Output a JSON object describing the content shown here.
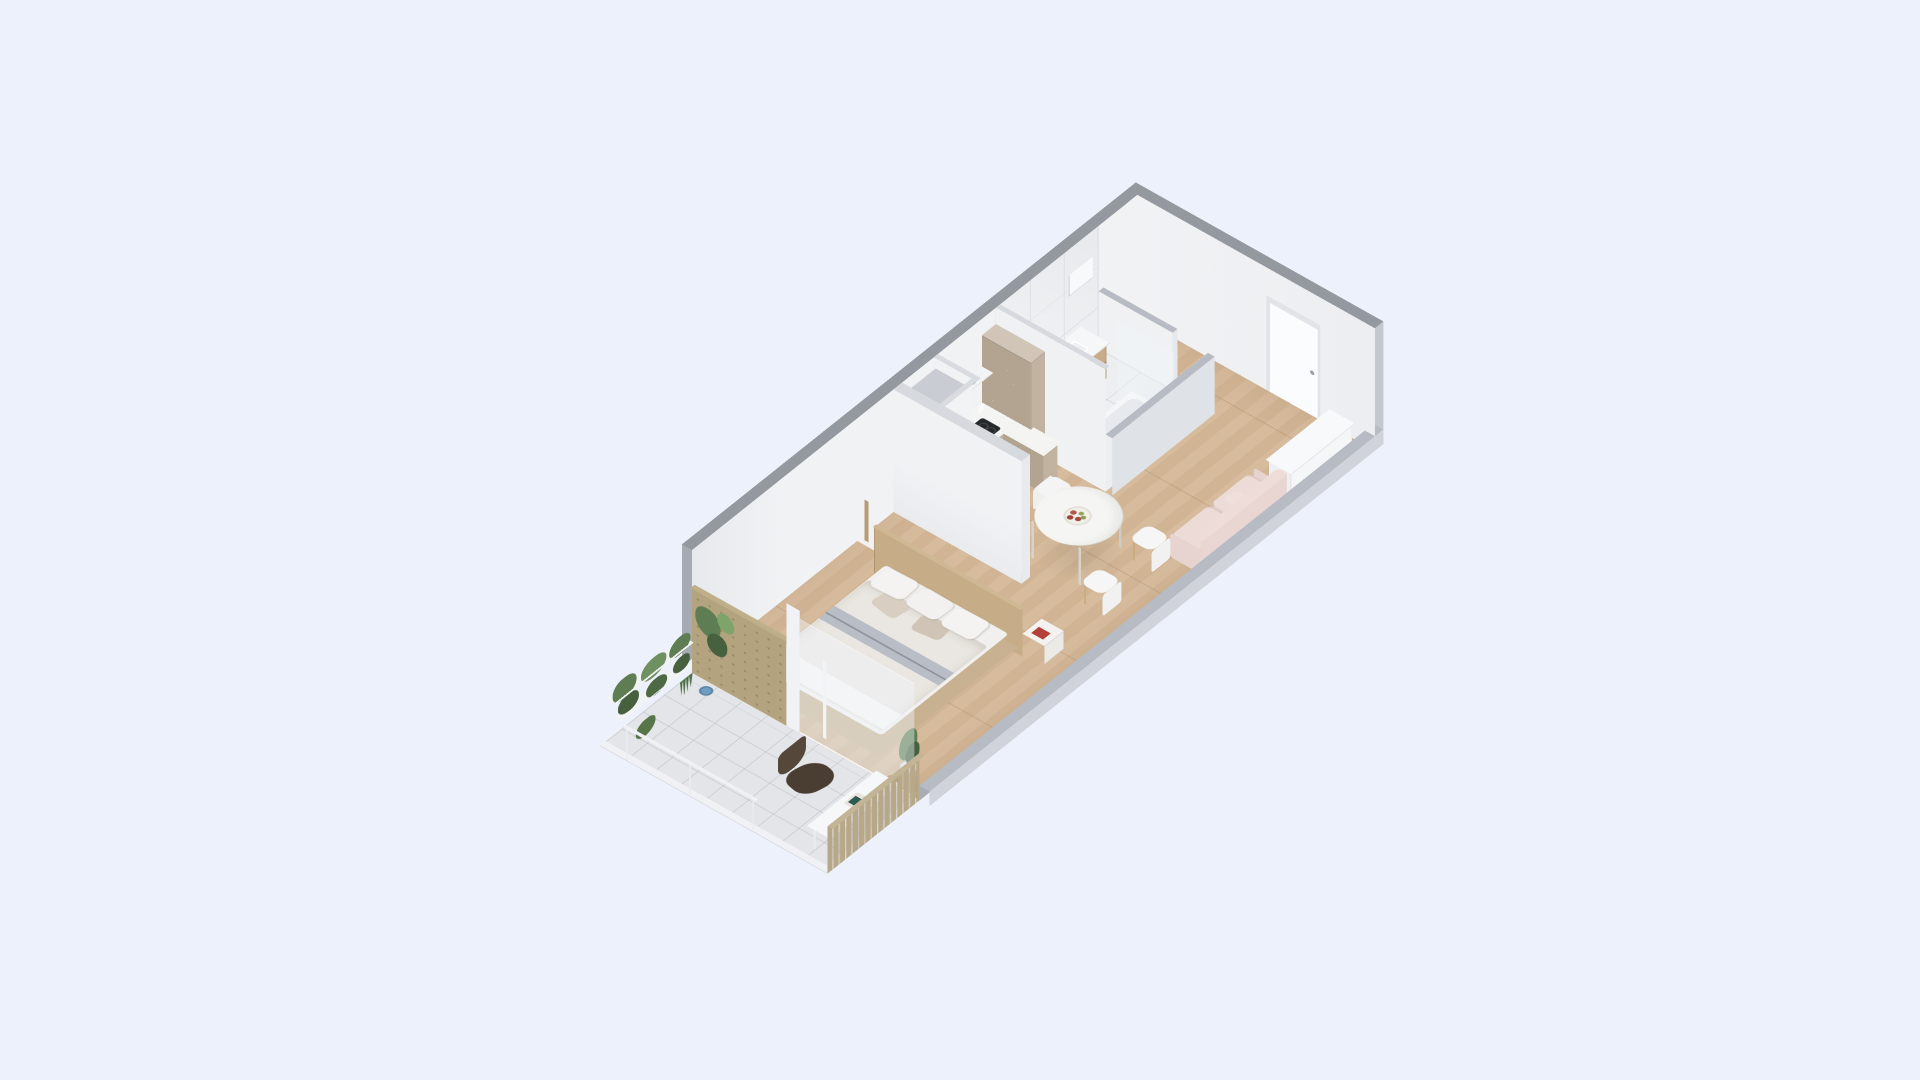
{
  "scene": {
    "title": "Isometric 3D floor plan render of a compact studio apartment",
    "type": "architectural 3D floor plan",
    "background_color": "#edf1fb",
    "view": "axonometric dollhouse cutaway, long axis lower-left to upper-right"
  },
  "palette": {
    "bg": "#edf1fb",
    "wall_top": "#94989f",
    "wall_outer": "#a6aab3",
    "wall_side": "#c3c7cf",
    "wall_inner_white": "#f1f2f4",
    "wall_shade": "#e7e9ed",
    "front_cap": "#b7bbc3",
    "front_outer": "#d0d4da",
    "front_inner": "#a9adb5",
    "floor_wood": "#d6bb9d",
    "floor_wood_alt": "#d0b494",
    "floor_tile": "#e3e5e8",
    "marble": "#eef0f2",
    "cabinet": "#c2b2a0",
    "cabinet_dark": "#b3a391",
    "cabinet_top": "#d0c5b6",
    "counter_white": "#f4f5f3",
    "appliance_black": "#26282b",
    "oven_black": "#2b2e31",
    "wood_furniture": "#c6ad87",
    "wood_dark": "#b89f7e",
    "white_furniture": "#f5f6f8",
    "duvet": "#eae7e2",
    "duvet_stripe": "#b9bdc6",
    "sheet_white": "#f6f5f3",
    "pillow_taupe": "#d8cec2",
    "sofa": "#e9d6d2",
    "sofa_light": "#f0e0dc",
    "leather": "#4a3e33",
    "leather_light": "#554739",
    "plant": "#5f7d52",
    "plant_dark": "#47603e",
    "plant_light": "#7ea46c",
    "plywood": "#b3a37f",
    "slat": "#b6a888",
    "pot_blue": "#6f9ec0",
    "book_red": "#b5403b",
    "book_teal": "#2e5a55",
    "chrome": "#b9bec4",
    "glass": "rgba(238,245,250,0.42)"
  },
  "rooms": [
    {
      "id": "balcony",
      "label": "Balcony",
      "items": [
        "hanging plants on white shelf rack",
        "snake plant",
        "climbing plant",
        "blue plant pot",
        "plywood wall panel",
        "slatted privacy screen",
        "dark leather lounge chair",
        "long white console table",
        "serving tray with teal book",
        "wood stool",
        "tile floor",
        "white railing"
      ]
    },
    {
      "id": "bedroom",
      "label": "Bedroom",
      "items": [
        "double bed with white and beige bedding",
        "gray stripe duvet",
        "five pillows",
        "wood headboard panel",
        "nightstand with wood lamp and black speaker",
        "nightstand with red book",
        "slim white floor lamp",
        "potted plant at bed foot",
        "wood plank floor"
      ]
    },
    {
      "id": "kitchen",
      "label": "Kitchen",
      "items": [
        "taupe base cabinets",
        "white countertop",
        "black induction cooktop",
        "built-in oven",
        "sink with chrome faucet",
        "black toaster",
        "open shelf with jars and candles",
        "tall taupe cabinet",
        "utility shaft with access panel"
      ]
    },
    {
      "id": "dining",
      "label": "Dining area",
      "items": [
        "round white table",
        "three white chairs with wood legs",
        "fruit bowl with red and green apples"
      ]
    },
    {
      "id": "living",
      "label": "Living area",
      "items": [
        "blush pink sofa",
        "two seat cushions",
        "throw pillow"
      ]
    },
    {
      "id": "bathroom",
      "label": "Bathroom",
      "items": [
        "marble tiled back wall",
        "marble floor",
        "vanity with basin and wood drawers",
        "bathtub",
        "glass shower screen",
        "recessed wall niche"
      ]
    },
    {
      "id": "entry",
      "label": "Entry hall",
      "items": [
        "white entry door with handle",
        "white sideboard",
        "wood corridor floor"
      ]
    }
  ]
}
